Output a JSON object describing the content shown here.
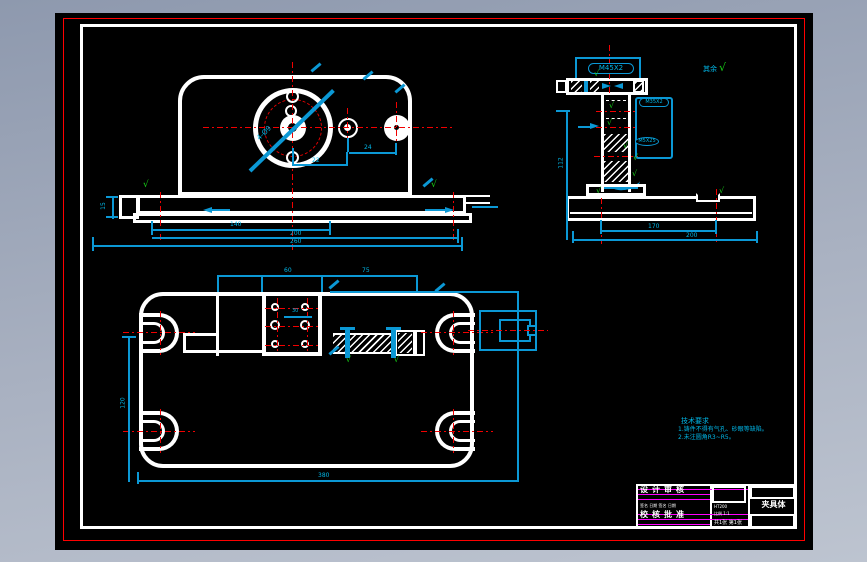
{
  "symbols": {
    "check": "√",
    "rest_label": "其余"
  },
  "callouts": {
    "flange": "M45X2",
    "boss": "M35X2",
    "pin": "M5X25"
  },
  "front": {
    "dim_bolt": "4-Ø9",
    "dim_22": "22",
    "dim_24": "24",
    "dim_140": "140",
    "dim_200": "200",
    "dim_260": "260",
    "dim_tab": "15"
  },
  "side": {
    "dim_170": "170",
    "dim_200": "200",
    "dim_112": "112"
  },
  "plan": {
    "dim_60": "60",
    "dim_75": "75",
    "dim_30": "30",
    "dim_380": "380",
    "dim_120": "120"
  },
  "tech": {
    "title": "技术要求",
    "line1": "1.铸件不得有气孔、砂眼等缺陷。",
    "line2": "2.未注圆角R3~R5。"
  },
  "titleblock": {
    "part": "夹具体",
    "row1": "设计审核",
    "row2": "校核批准",
    "specks": "签名 日期 签名 日期",
    "material": "HT200",
    "scale": "比例 1:1",
    "sheet": "共1张 第1张"
  },
  "colors": {
    "line_cyan": "#0b98d5",
    "line_red": "#f20000",
    "line_green": "#17d317",
    "line_magenta": "#ff00ff",
    "sheet": "#000000"
  }
}
